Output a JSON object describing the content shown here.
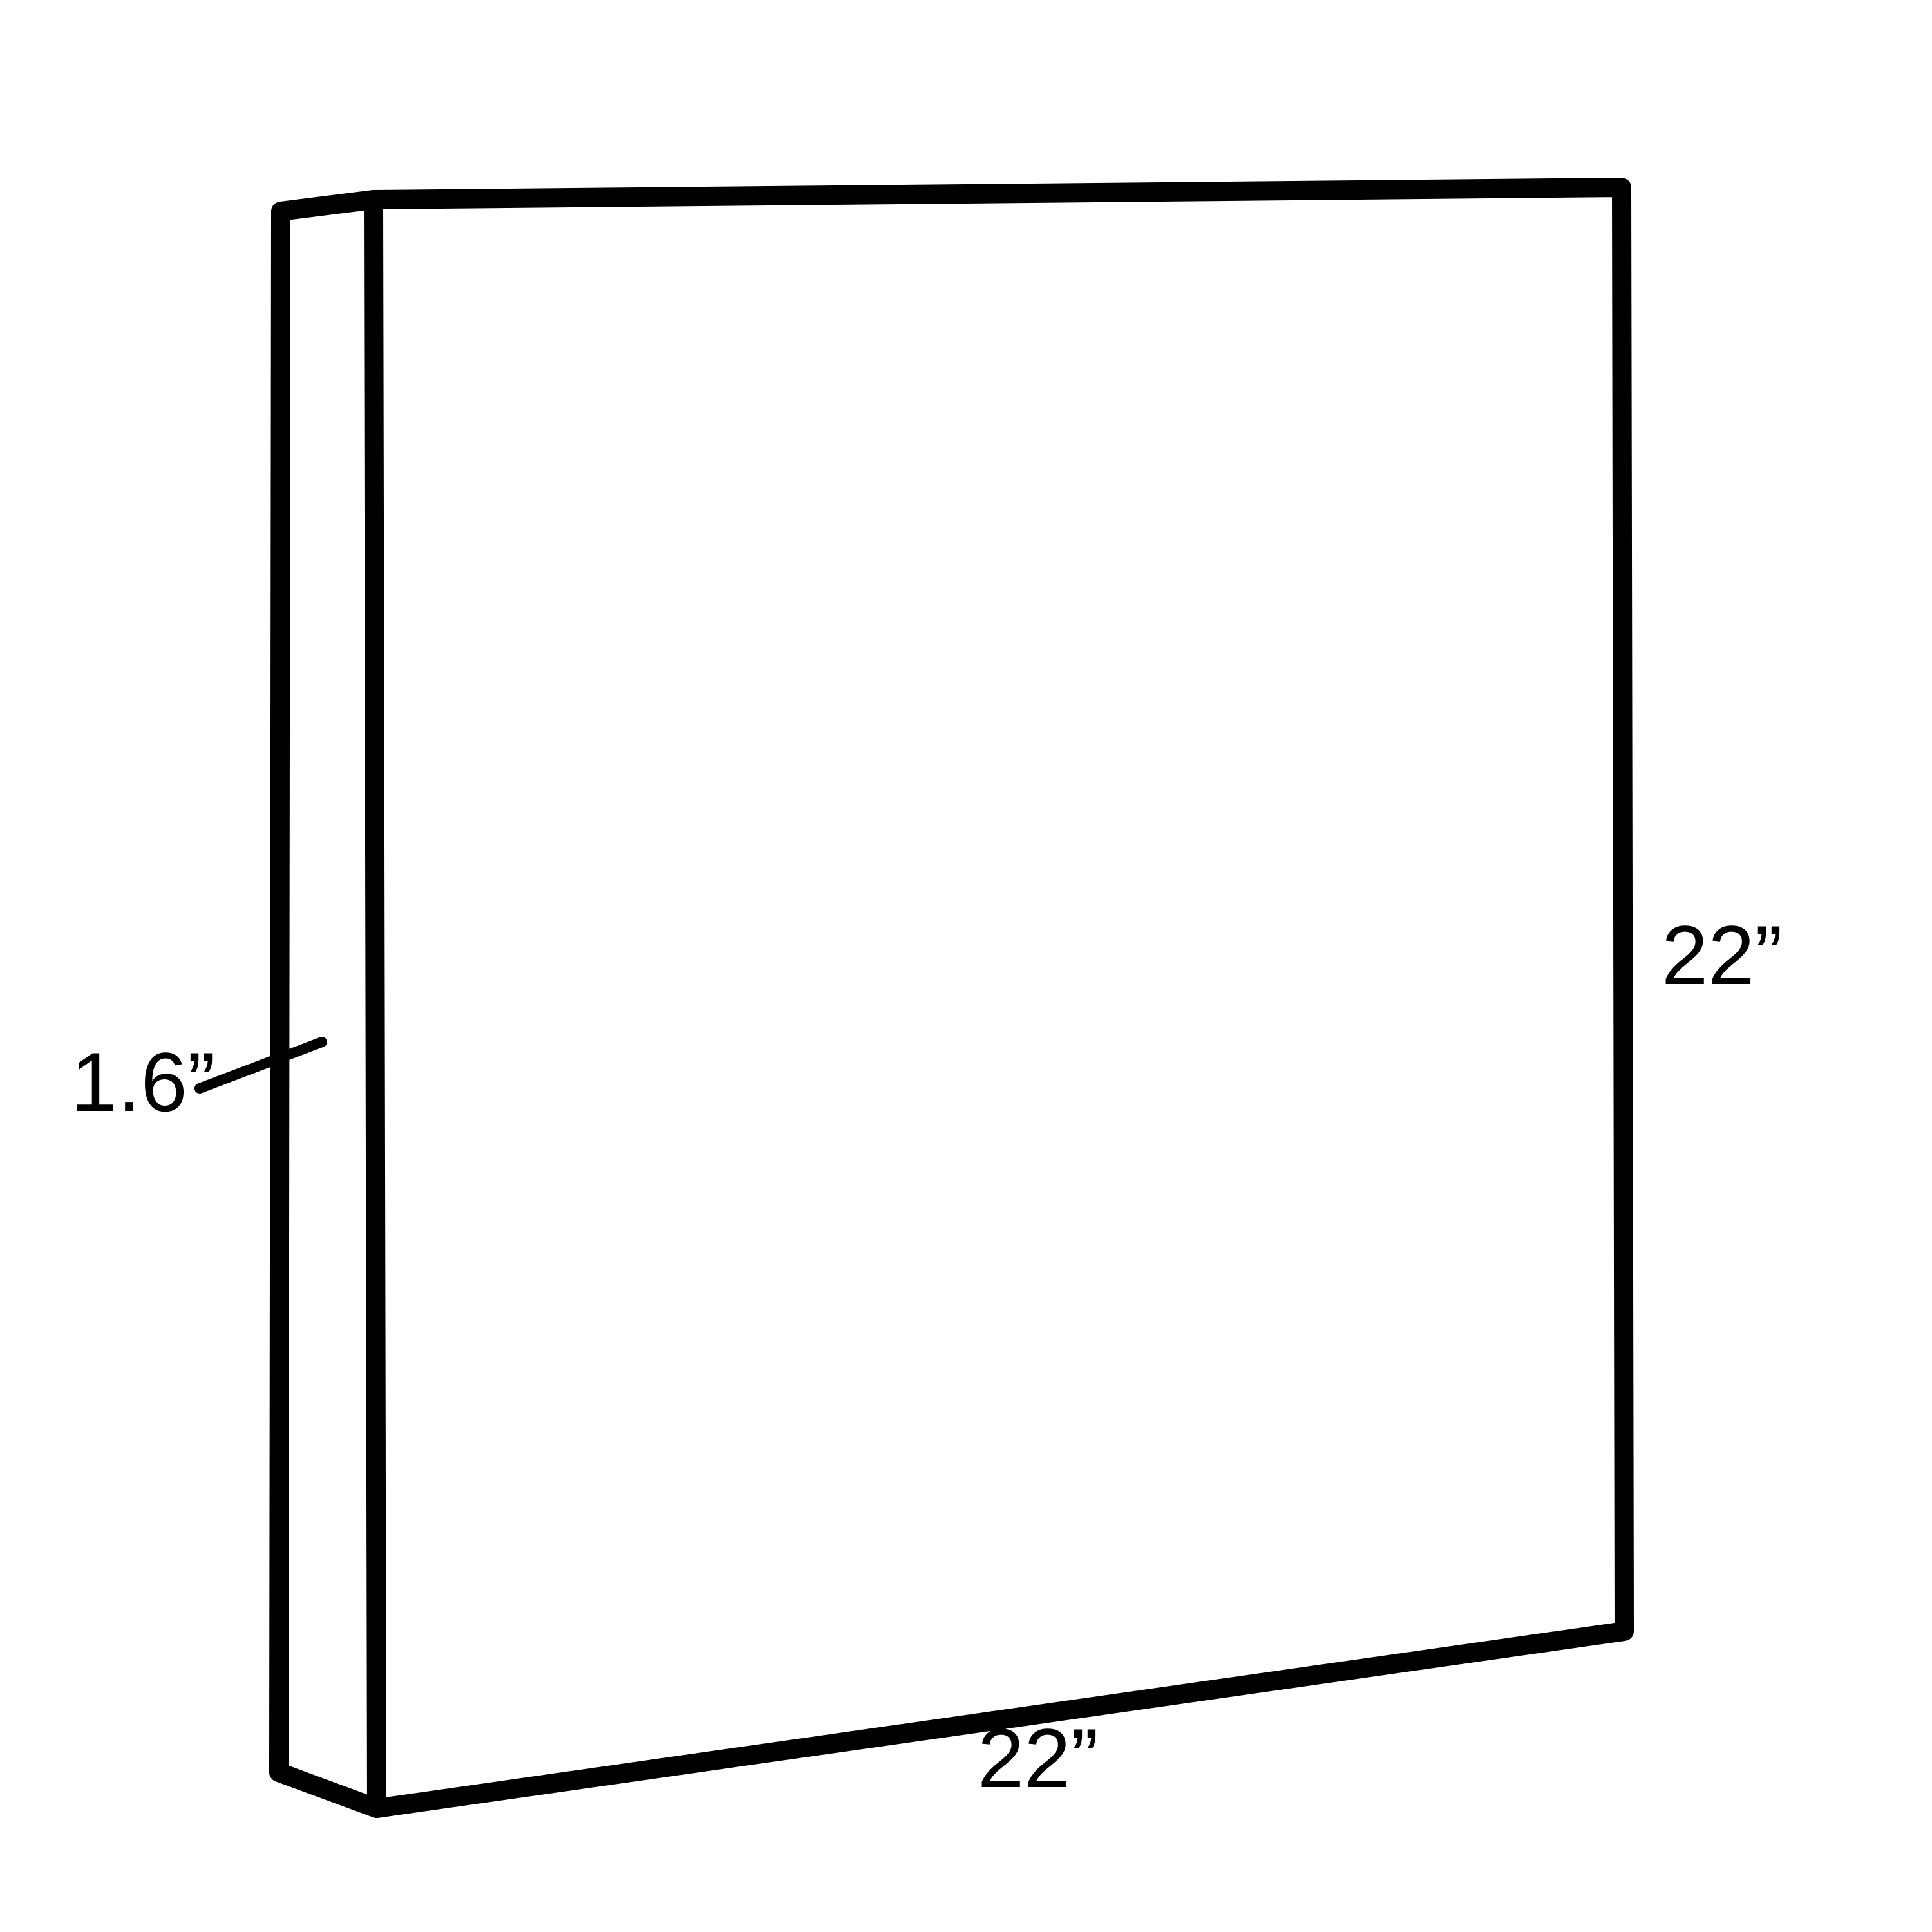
{
  "diagram": {
    "type": "dimension-drawing",
    "subject": "thin rectangular panel shown in 3D perspective",
    "colors": {
      "line": "#000000",
      "background": "#ffffff"
    },
    "dimensions": {
      "depth": {
        "label": "1.6”",
        "value": 1.6,
        "unit": "inches"
      },
      "height": {
        "label": "22”",
        "value": 22,
        "unit": "inches"
      },
      "width": {
        "label": "22”",
        "value": 22,
        "unit": "inches"
      }
    }
  }
}
